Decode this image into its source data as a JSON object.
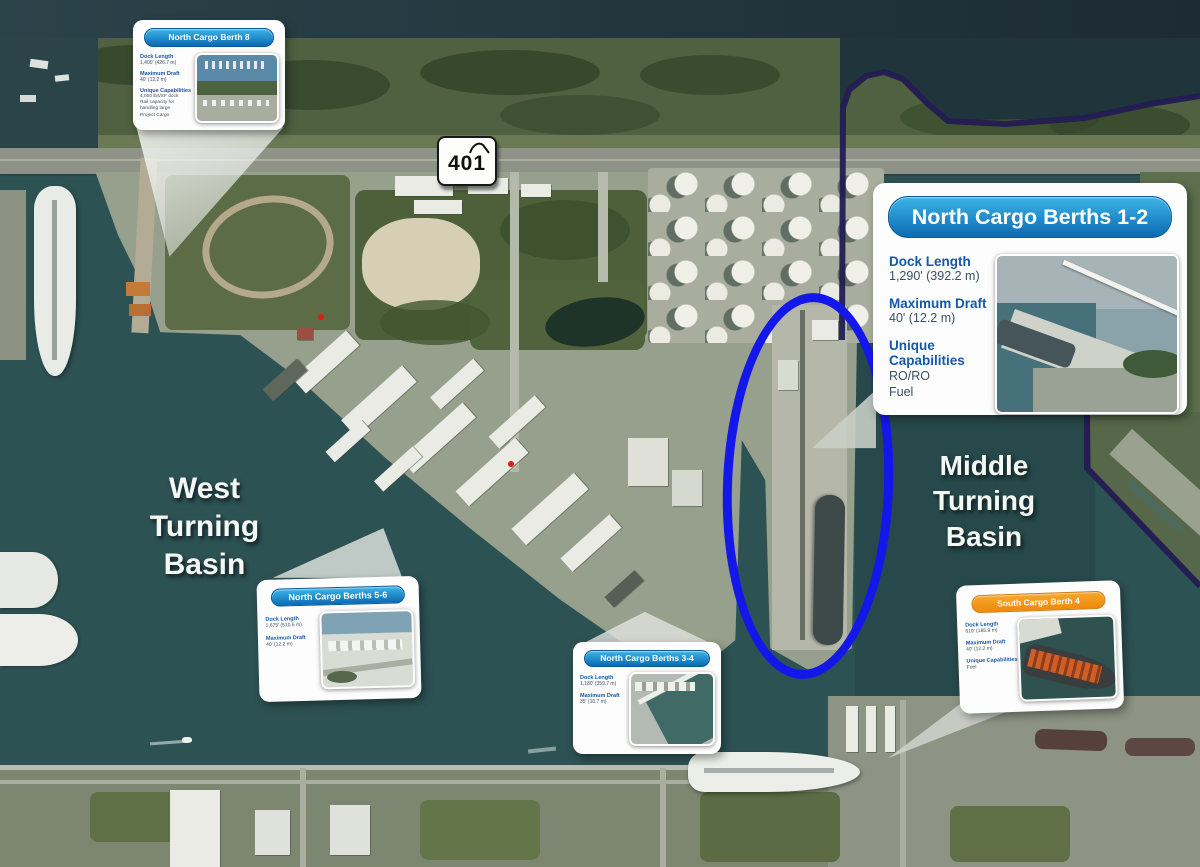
{
  "region_labels": {
    "west": [
      "West",
      "Turning",
      "Basin"
    ],
    "middle": [
      "Middle",
      "Turning",
      "Basin"
    ]
  },
  "route_shield": {
    "number": "401"
  },
  "cards": {
    "ncb8": {
      "title": "North Cargo Berth 8",
      "fields": [
        {
          "label": "Dock Length",
          "value": "1,400' (426.7 m)"
        },
        {
          "label": "Maximum Draft",
          "value": "40' (12.2 m)"
        },
        {
          "label": "Unique Capabilities",
          "value": "4,000 lbs/SF dock\nRail capacity for\nhandling large\nProject Cargo"
        }
      ]
    },
    "ncb12": {
      "title": "North Cargo Berths 1-2",
      "fields": [
        {
          "label": "Dock Length",
          "value": "1,290' (392.2 m)"
        },
        {
          "label": "Maximum Draft",
          "value": "40' (12.2 m)"
        },
        {
          "label": "Unique Capabilities",
          "value": "RO/RO\nFuel"
        }
      ]
    },
    "ncb56": {
      "title": "North Cargo Berths 5-6",
      "fields": [
        {
          "label": "Dock Length",
          "value": "1,675' (510.5 m)"
        },
        {
          "label": "Maximum Draft",
          "value": "40' (12.2 m)"
        }
      ]
    },
    "ncb34": {
      "title": "North Cargo Berths 3-4",
      "fields": [
        {
          "label": "Dock Length",
          "value": "1,180' (359.7 m)"
        },
        {
          "label": "Maximum Draft",
          "value": "35' (10.7 m)"
        }
      ]
    },
    "scb4": {
      "title": "South Cargo Berth 4",
      "fields": [
        {
          "label": "Dock Length",
          "value": "610' (185.9 m)"
        },
        {
          "label": "Maximum Draft",
          "value": "40' (12.2 m)"
        },
        {
          "label": "Unique Capabilities",
          "value": "Fuel"
        }
      ]
    }
  },
  "colors": {
    "highlight_ellipse": "#1417ea",
    "boundary_line": "#241c52",
    "card_header_blue": "#1286cc",
    "card_header_orange": "#f5971d",
    "field_label_blue": "#1558a8"
  }
}
